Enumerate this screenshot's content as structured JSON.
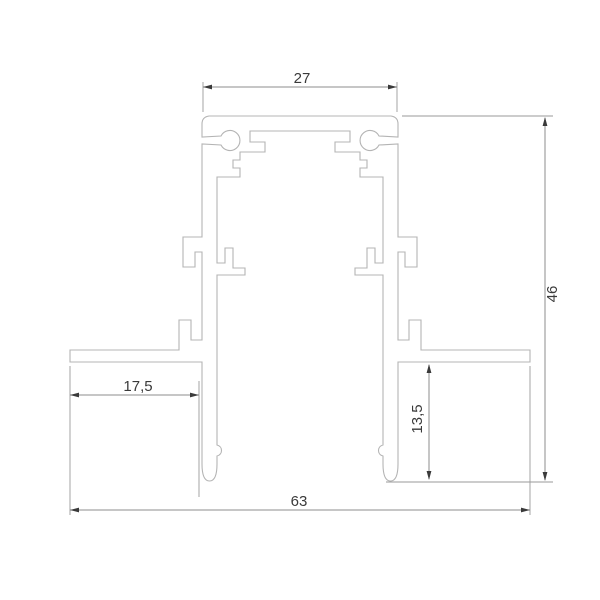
{
  "drawing": {
    "kind": "technical-cross-section",
    "subject": "recessed track profile",
    "background_color": "#ffffff",
    "profile_line_color": "#b4b4b4",
    "dimension_line_color": "#8c8c8c",
    "arrow_color": "#3a3a3a",
    "text_color": "#3a3a3a",
    "dimensions": {
      "top_width": {
        "label": "27",
        "value": 27,
        "unit": "mm",
        "orientation": "horizontal",
        "position": "top"
      },
      "overall_width": {
        "label": "63",
        "value": 63,
        "unit": "mm",
        "orientation": "horizontal",
        "position": "bottom"
      },
      "overall_height": {
        "label": "46",
        "value": 46,
        "unit": "mm",
        "orientation": "vertical",
        "position": "right"
      },
      "wing_width": {
        "label": "17,5",
        "value": 17.5,
        "unit": "mm",
        "orientation": "horizontal",
        "position": "left-wing"
      },
      "wing_depth": {
        "label": "13,5",
        "value": 13.5,
        "unit": "mm",
        "orientation": "vertical",
        "position": "right-wing"
      }
    }
  }
}
